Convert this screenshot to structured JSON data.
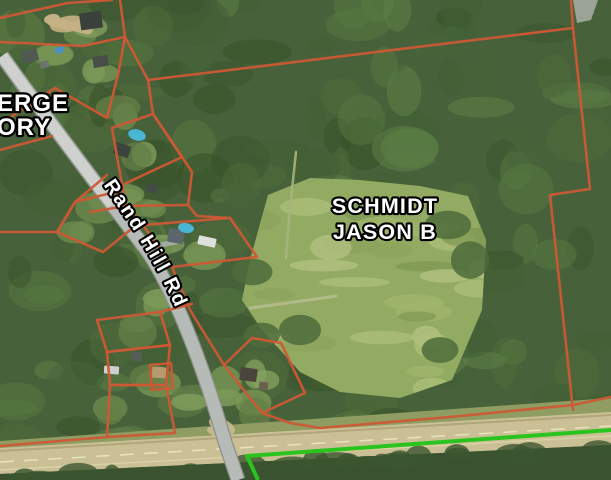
{
  "map": {
    "labels": {
      "owner_line1": "SCHMIDT",
      "owner_line2": "JASON B",
      "partial_owner_line1": "ERGE",
      "partial_owner_line2": "ORY",
      "road_name": "Rand Hill Rd"
    },
    "colors": {
      "parcel_line": "#cd5835",
      "boundary_green": "#2bc31d",
      "forest_base": "#47623a",
      "forest_dark_palette": [
        "#3b5530",
        "#425e33",
        "#4e6c3b",
        "#55763f",
        "#365028",
        "#5d8045",
        "#47653a"
      ],
      "lawn_palette": [
        "#6f8c50",
        "#7b9a57",
        "#647f47",
        "#86a160"
      ],
      "meadow": "#93aa63",
      "meadow_streak_palette": [
        "#a2b76e",
        "#8aa35a",
        "#aec07b",
        "#7e9751",
        "#b5c386"
      ],
      "highway": "#cbc095",
      "highway_edge": "#b0a57b",
      "highway_dash": "#e9e2bf",
      "verge": "#8f9c62",
      "below_highway": "#3a5230",
      "road_fill": "#b7bbb7",
      "road_casing": "#8b9189",
      "road_light": "#d2d5d2",
      "pool": "#49b6d4",
      "label_fill": "#ffffff",
      "label_outline": "#000000"
    },
    "meadow_polygon": [
      [
        268,
        195
      ],
      [
        310,
        178
      ],
      [
        360,
        180
      ],
      [
        420,
        186
      ],
      [
        468,
        196
      ],
      [
        486,
        240
      ],
      [
        482,
        310
      ],
      [
        452,
        380
      ],
      [
        400,
        398
      ],
      [
        340,
        392
      ],
      [
        300,
        372
      ],
      [
        262,
        330
      ],
      [
        242,
        300
      ],
      [
        250,
        260
      ]
    ],
    "verge_polygon": [
      [
        0,
        441
      ],
      [
        611,
        398
      ],
      [
        611,
        414
      ],
      [
        0,
        450
      ]
    ],
    "highway_polygon": [
      [
        0,
        448
      ],
      [
        611,
        412
      ],
      [
        611,
        445
      ],
      [
        250,
        462
      ],
      [
        0,
        474
      ]
    ],
    "below_highway_polygon": [
      [
        0,
        474
      ],
      [
        250,
        462
      ],
      [
        611,
        445
      ],
      [
        611,
        480
      ],
      [
        0,
        480
      ]
    ],
    "highway_lines": [
      {
        "d": "M 0,451 L 611,415",
        "w": 2,
        "color": "#b0a57b",
        "dash": ""
      },
      {
        "d": "M 0,462 L 611,426",
        "w": 1.5,
        "color": "#e9e2bf",
        "dash": "14 10"
      },
      {
        "d": "M 0,470 L 611,436",
        "w": 1.2,
        "color": "#ddd4ab",
        "dash": ""
      }
    ],
    "road_path": "M 2,56 C 55,130 105,195 148,252 C 172,288 200,355 225,442 L 238,480",
    "road_label_path": "M 102,183 C 140,239 163,272 191,345",
    "lawn_spots": [
      [
        95,
        70
      ],
      [
        120,
        110
      ],
      [
        140,
        160
      ],
      [
        150,
        210
      ],
      [
        170,
        250
      ],
      [
        120,
        190
      ],
      [
        200,
        250
      ],
      [
        130,
        330
      ],
      [
        150,
        380
      ],
      [
        190,
        400
      ],
      [
        230,
        390
      ],
      [
        260,
        380
      ],
      [
        110,
        415
      ],
      [
        75,
        225
      ],
      [
        100,
        200
      ],
      [
        250,
        410
      ],
      [
        160,
        300
      ],
      [
        60,
        55
      ],
      [
        85,
        30
      ]
    ],
    "meadow_dark_clumps": [
      [
        448,
        225
      ],
      [
        470,
        260
      ],
      [
        252,
        272
      ],
      [
        262,
        335
      ],
      [
        300,
        330
      ],
      [
        440,
        350
      ]
    ],
    "dirt_patches": [
      {
        "x": 68,
        "y": 24,
        "rx": 18,
        "ry": 8,
        "rot": -10,
        "color": "#c6b185"
      },
      {
        "x": 52,
        "y": 19,
        "rx": 8,
        "ry": 5,
        "rot": -10,
        "color": "#cdb98d"
      },
      {
        "x": 222,
        "y": 426,
        "rx": 14,
        "ry": 7,
        "rot": 25,
        "color": "#c9ba90"
      }
    ],
    "corner_road_patch": [
      [
        573,
        0
      ],
      [
        598,
        0
      ],
      [
        591,
        20
      ],
      [
        577,
        23
      ]
    ],
    "trails": [
      {
        "d": "M 250,308 C 280,304 310,300 336,296",
        "w": 3,
        "color": "#b6bd8c"
      },
      {
        "d": "M 296,152 C 292,190 288,225 286,258",
        "w": 2.5,
        "color": "#a8b47e"
      },
      {
        "d": "M 210,430 L 232,446",
        "w": 6,
        "color": "#c9ba90"
      },
      {
        "d": "M 52,22 C 64,24 76,27 88,30",
        "w": 9,
        "color": "#c6b185"
      },
      {
        "d": "M 150,247 L 176,242",
        "w": 5,
        "color": "#a9ada9"
      }
    ],
    "buildings": [
      {
        "x": 80,
        "y": 12,
        "w": 22,
        "h": 17,
        "rot": -8,
        "color": "#3a403a"
      },
      {
        "x": 22,
        "y": 50,
        "w": 16,
        "h": 12,
        "rot": -14,
        "color": "#525852"
      },
      {
        "x": 40,
        "y": 61,
        "w": 9,
        "h": 7,
        "rot": -14,
        "color": "#6d736d"
      },
      {
        "x": 93,
        "y": 56,
        "w": 15,
        "h": 11,
        "rot": -10,
        "color": "#474d47"
      },
      {
        "x": 114,
        "y": 144,
        "w": 16,
        "h": 12,
        "rot": 18,
        "color": "#3d433d"
      },
      {
        "x": 147,
        "y": 184,
        "w": 11,
        "h": 9,
        "rot": 18,
        "color": "#454b45"
      },
      {
        "x": 168,
        "y": 229,
        "w": 16,
        "h": 14,
        "rot": 10,
        "color": "#5c666c"
      },
      {
        "x": 198,
        "y": 237,
        "w": 18,
        "h": 9,
        "rot": 12,
        "color": "#dde1dd"
      },
      {
        "x": 104,
        "y": 366,
        "w": 15,
        "h": 8,
        "rot": 4,
        "color": "#ccd0cc"
      },
      {
        "x": 131,
        "y": 352,
        "w": 11,
        "h": 9,
        "rot": 4,
        "color": "#575d57"
      },
      {
        "x": 152,
        "y": 367,
        "w": 14,
        "h": 11,
        "rot": 4,
        "color": "#b59b6e"
      },
      {
        "x": 240,
        "y": 368,
        "w": 17,
        "h": 13,
        "rot": 8,
        "color": "#4a443c"
      },
      {
        "x": 259,
        "y": 382,
        "w": 9,
        "h": 8,
        "rot": 8,
        "color": "#6b5f4f"
      },
      {
        "x": 55,
        "y": 47,
        "w": 9,
        "h": 6,
        "rot": -15,
        "color": "#4a8fc4"
      }
    ],
    "pools": [
      {
        "x": 137,
        "y": 135,
        "rx": 9,
        "ry": 5.5,
        "rot": 15
      },
      {
        "x": 186,
        "y": 228,
        "rx": 8,
        "ry": 5,
        "rot": 10
      }
    ],
    "parcel_lines": [
      [
        [
          0,
          18
        ],
        [
          68,
          3
        ],
        [
          112,
          0
        ]
      ],
      [
        [
          0,
          42
        ],
        [
          83,
          46
        ],
        [
          125,
          37
        ],
        [
          120,
          0
        ]
      ],
      [
        [
          125,
          37
        ],
        [
          148,
          80
        ]
      ],
      [
        [
          148,
          80
        ],
        [
          573,
          28
        ]
      ],
      [
        [
          571,
          0
        ],
        [
          573,
          28
        ],
        [
          590,
          189
        ],
        [
          550,
          195
        ],
        [
          573,
          410
        ]
      ],
      [
        [
          611,
          397
        ],
        [
          573,
          405
        ],
        [
          450,
          417
        ],
        [
          320,
          428
        ],
        [
          290,
          423
        ],
        [
          262,
          413
        ]
      ],
      [
        [
          262,
          413
        ],
        [
          224,
          365
        ],
        [
          252,
          338
        ],
        [
          281,
          343
        ],
        [
          305,
          393
        ],
        [
          262,
          413
        ]
      ],
      [
        [
          172,
          267
        ],
        [
          190,
          310
        ],
        [
          224,
          365
        ]
      ],
      [
        [
          143,
          225
        ],
        [
          230,
          218
        ],
        [
          257,
          257
        ],
        [
          172,
          267
        ],
        [
          143,
          225
        ]
      ],
      [
        [
          148,
          80
        ],
        [
          153,
          114
        ],
        [
          182,
          157
        ],
        [
          192,
          172
        ],
        [
          188,
          205
        ],
        [
          197,
          216
        ],
        [
          230,
          218
        ]
      ],
      [
        [
          112,
          128
        ],
        [
          153,
          114
        ],
        [
          182,
          157
        ],
        [
          122,
          185
        ],
        [
          112,
          128
        ]
      ],
      [
        [
          90,
          212
        ],
        [
          126,
          206
        ],
        [
          188,
          205
        ]
      ],
      [
        [
          122,
          185
        ],
        [
          126,
          206
        ]
      ],
      [
        [
          0,
          124
        ],
        [
          55,
          88
        ],
        [
          107,
          118
        ],
        [
          118,
          75
        ],
        [
          125,
          37
        ]
      ],
      [
        [
          0,
          232
        ],
        [
          57,
          232
        ],
        [
          75,
          202
        ],
        [
          107,
          175
        ]
      ],
      [
        [
          57,
          232
        ],
        [
          75,
          202
        ],
        [
          115,
          192
        ],
        [
          140,
          222
        ],
        [
          103,
          252
        ],
        [
          57,
          232
        ]
      ],
      [
        [
          0,
          150
        ],
        [
          52,
          136
        ]
      ],
      [
        [
          97,
          320
        ],
        [
          160,
          312
        ],
        [
          170,
          345
        ],
        [
          107,
          352
        ],
        [
          97,
          320
        ]
      ],
      [
        [
          107,
          352
        ],
        [
          170,
          345
        ],
        [
          166,
          385
        ],
        [
          110,
          385
        ],
        [
          107,
          352
        ]
      ],
      [
        [
          150,
          365
        ],
        [
          171,
          363
        ],
        [
          173,
          388
        ],
        [
          152,
          390
        ],
        [
          150,
          365
        ]
      ],
      [
        [
          110,
          385
        ],
        [
          166,
          385
        ],
        [
          175,
          433
        ],
        [
          107,
          437
        ],
        [
          110,
          385
        ]
      ],
      [
        [
          0,
          446
        ],
        [
          107,
          437
        ]
      ],
      [
        [
          160,
          312
        ],
        [
          192,
          304
        ]
      ]
    ],
    "green_boundary": [
      [
        258,
        480
      ],
      [
        247,
        456
      ],
      [
        611,
        430
      ]
    ]
  }
}
